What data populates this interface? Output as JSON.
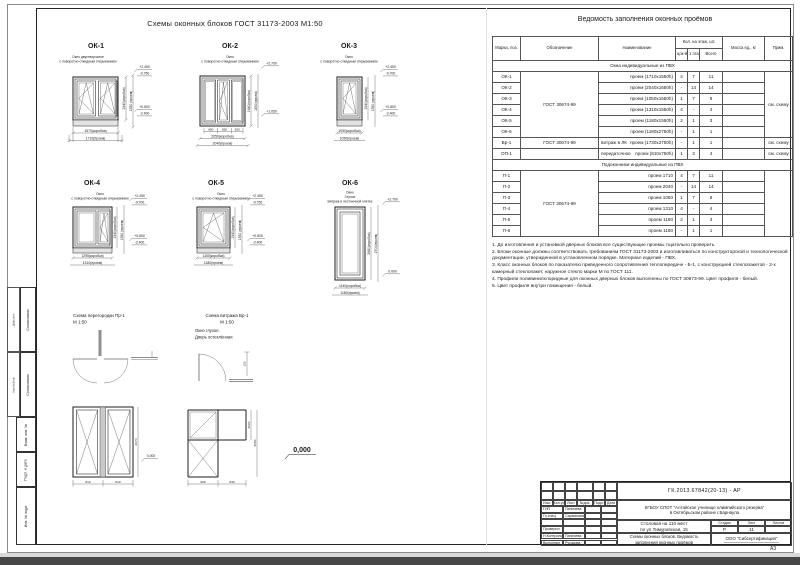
{
  "sheet": {
    "title": "Схемы оконных блоков ГОСТ 31173-2003 М1:50",
    "format": "А3"
  },
  "windows": [
    {
      "id": "ОК-1",
      "s1": "Окно двустворчатое",
      "s2": "с поворотно-откидным открыванием",
      "w1": "1570(коробка)",
      "w2": "1710(проем)",
      "h1": "1540(коробка)",
      "h2": "1550 (проем)",
      "e_top1": "+2.450",
      "e_top2": "-0.750",
      "e_bot1": "+0.800",
      "e_bot2": "-2.400"
    },
    {
      "id": "ОК-2",
      "s1": "Окно",
      "s2": "с поворотно-откидным открыванием",
      "sash": "650",
      "w1": "2050(коробка)",
      "w2": "2040(проем)",
      "h1": "1640(коробка)",
      "h2": "1650(проем)",
      "e_top1": "+2.700",
      "e_bot1": "+1.050"
    },
    {
      "id": "ОК-3",
      "s1": "Окно",
      "s2": "с поворотно-откидным открыванием",
      "w1": "1050(коробка)",
      "w2": "1050(проем)",
      "h1": "1540(коробка)",
      "h2": "1550 (проем)",
      "e_top1": "+2.450",
      "e_top2": "-0.700",
      "e_bot1": "+0.800",
      "e_bot2": "-2.400"
    },
    {
      "id": "ОК-4",
      "s1": "Окно",
      "s2": "с поворотно-откидным открыванием",
      "w1": "1295(коробка)",
      "w2": "1310(проем)",
      "h1": "1540(коробка)",
      "h2": "1550 (проем)",
      "e_top1": "+2.450",
      "e_top2": "-0.700",
      "e_bot1": "+0.800",
      "e_bot2": "-2.400"
    },
    {
      "id": "ОК-5",
      "s1": "Окно",
      "s2": "с поворотно-откидным открыванием",
      "w1": "1160(коробка)",
      "w2": "1180(проем)",
      "h1": "1540(коробка)",
      "h2": "1550 (проем)",
      "e_top1": "+2.450",
      "e_top2": "-0.750",
      "e_bot1": "+0.800",
      "e_bot2": "-2.400"
    },
    {
      "id": "ОК-6",
      "s1": "Окно",
      "s2": "Глухое",
      "s3": "Витраж в лестничной клетке",
      "w1": "1140(коробка)",
      "w2": "1180(проем)",
      "h1": "2680(коробка)",
      "h2": "2700(проем)",
      "e_top1": "+2.700",
      "e_bot1": "0.000"
    }
  ],
  "schemes": {
    "partition": {
      "title": "Схема перегородки Пр-1",
      "scale": "М 1:50",
      "dim_w1": "810",
      "dim_w2": "810",
      "dim_h": "2070",
      "zero": "0,000"
    },
    "vitrage": {
      "title": "Схема витража Вр-1",
      "scale": "М 1:50",
      "note1": "Окно глухое.",
      "note2": "Дверь остеклённая",
      "dim_w1": "900",
      "dim_w2": "830",
      "dim_h1": "2050",
      "dim_h2": "2000",
      "dim_plan": "120"
    },
    "zero_mark": "0,000"
  },
  "table": {
    "title": "Ведомость заполнения оконных проёмов",
    "headers": {
      "mark": "Марка, поз.",
      "designation": "Обозначение",
      "name": "Наименование",
      "qty": "Кол. на этаж, шт.",
      "floor0": "цок-й этаж",
      "floor1": "1 этаж",
      "total": "Всего",
      "mass": "Масса ед., кг",
      "note": "Прим."
    },
    "rows": [
      {
        "group": "Окна индивидуальные из ПВХ"
      },
      {
        "mark": "ОК-1",
        "oboz": "ГОСТ 30674-99",
        "oboz_span": 6,
        "name": "проем (1710х1550h)",
        "c1": "4",
        "c2": "7",
        "c3": "11",
        "note": "см. схему",
        "note_span": 6
      },
      {
        "mark": "ОК-2",
        "name": "проем (2040х1650h)",
        "c1": "-",
        "c2": "14",
        "c3": "14"
      },
      {
        "mark": "ОК-3",
        "name": "проем (1050х1550h)",
        "c1": "1",
        "c2": "7",
        "c3": "8"
      },
      {
        "mark": "ОК-4",
        "name": "проем (1310х1550h)",
        "c1": "4",
        "c2": "-",
        "c3": "4"
      },
      {
        "mark": "ОК-5",
        "name": "проем (1180х1550h)",
        "c1": "2",
        "c2": "1",
        "c3": "3"
      },
      {
        "mark": "ОК-6",
        "name": "проем (1180х2750h)",
        "c1": "-",
        "c2": "1",
        "c3": "1"
      },
      {
        "mark": "Вр-1",
        "oboz": "ГОСТ 30674-99",
        "oboz_span": 1,
        "prefix": "витраж в ЛК",
        "name": "проем (1730х2750h)",
        "c1": "-",
        "c2": "1",
        "c3": "1",
        "note": "см. схему",
        "note_span": 1
      },
      {
        "mark": "ОП-1",
        "oboz": "",
        "oboz_span": 1,
        "prefix": "передаточное",
        "name": "проем (810х750h)",
        "c1": "1",
        "c2": "3",
        "c3": "4",
        "note": "см. схему",
        "note_span": 1
      },
      {
        "group": "Подоконники индивидуальные из ПВХ"
      },
      {
        "mark": "П-1",
        "oboz": "ГОСТ 30674-99",
        "oboz_span": 6,
        "name": "проем 1710",
        "c1": "4",
        "c2": "7",
        "c3": "11",
        "note": "",
        "note_span": 6
      },
      {
        "mark": "П-2",
        "name": "проем 2040",
        "c1": "-",
        "c2": "14",
        "c3": "14"
      },
      {
        "mark": "П-3",
        "name": "проем 1050",
        "c1": "1",
        "c2": "7",
        "c3": "8"
      },
      {
        "mark": "П-4",
        "name": "проем 1310",
        "c1": "4",
        "c2": "-",
        "c3": "4"
      },
      {
        "mark": "П-5",
        "name": "проем 1180",
        "c1": "2",
        "c2": "1",
        "c3": "3"
      },
      {
        "mark": "П-6",
        "name": "проем 1180",
        "c1": "-",
        "c2": "1",
        "c3": "1"
      }
    ]
  },
  "notes": [
    "1. До изготовления и установкой дверных блоков все существующие проемы тщательно проверить.",
    "2. Блоки оконные должны соответствовать требованиям ГОСТ 31173-2003 и изготавливаться по конструкторской и технологической документации, утвержденной в установленном порядке. Материал изделий - ПВХ.",
    "3. Класс оконных блоков по показателю приведенного сопротивления теплопередаче - Б-1, с конструкцией стеклопакетов - 2-х камерный стеклопакет, наружное стекло марки М по ГОСТ 111.",
    "4. Профили поливинилхлоридные для оконных дверных блоков выполнены по ГОСТ 30673-99. Цвет профиля - белый.",
    "5. Цвет профиля внутри помещения - белый."
  ],
  "titleblock": {
    "code": "ГК.2013.67842(20-13) - АР",
    "org1": "КГБОУ СПОТ \"Алтайское училище олимпийского резерва\"",
    "org2": "в Октябрьском районе г.Барнаула",
    "object1": "Столовая на 110 мест",
    "object2": "по ул.Тимуровская, 15",
    "doc1": "Схемы оконных блоков. Ведомость",
    "doc2": "заполнения оконных проёмов",
    "company": "ООО \"Сибсертификация\"",
    "stage_label": "Стадия",
    "sheet_label": "Лист",
    "sheets_label": "Листов",
    "stage": "Р",
    "sheet": "11",
    "sheets": "",
    "cols": [
      "Изм.",
      "Кол.уч",
      "Лист",
      "№док.",
      "Подп.",
      "Дата"
    ],
    "roles": [
      {
        "r": "ГИП",
        "n": "Паничева"
      },
      {
        "r": "Гл.спец",
        "n": "Сарманаева"
      },
      {
        "r": "",
        "n": ""
      },
      {
        "r": "Проверил",
        "n": ""
      },
      {
        "r": "Н.Контроль",
        "n": "Паничева"
      },
      {
        "r": "Выполнил",
        "n": "Русакова"
      }
    ]
  },
  "side_strip": {
    "agreed1": "Согласовано",
    "agreed2": "Согласовано",
    "name1": "Дубровин",
    "name2": "Коробейник",
    "inv1": "Взам. инв. №",
    "inv2": "Подп. и дата",
    "inv3": "Инв. № подл."
  }
}
